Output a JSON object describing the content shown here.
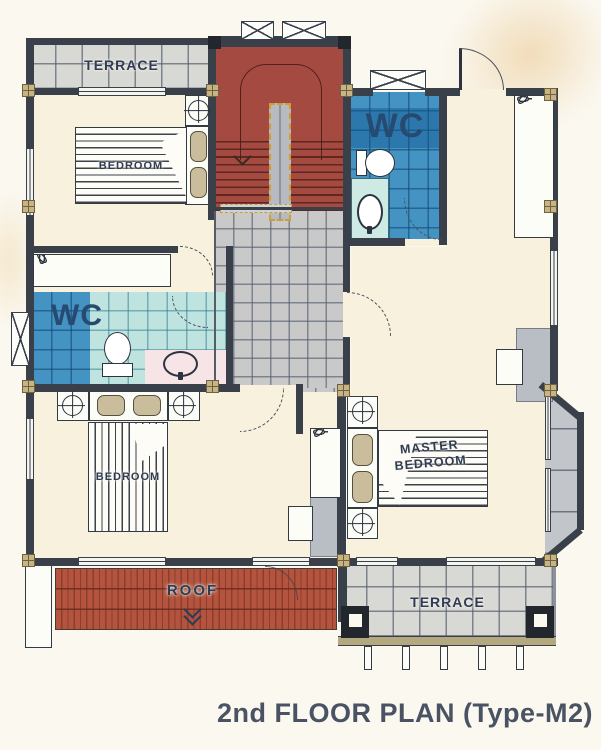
{
  "title": {
    "text": "2nd FLOOR PLAN (Type-M2)"
  },
  "rooms": {
    "terrace_top": {
      "label": "TERRACE"
    },
    "bedroom_top": {
      "label": "BEDROOM"
    },
    "wc_top": {
      "label": "WC"
    },
    "wc_mid": {
      "label": "WC"
    },
    "bedroom_bottom": {
      "label": "BEDROOM"
    },
    "master_bedroom": {
      "line1": "MASTER",
      "line2": "BEDROOM"
    },
    "roof": {
      "label": "ROOF"
    },
    "terrace_bottom": {
      "label": "TERRACE"
    }
  },
  "icons": {
    "stairs_direction": "down-arrow",
    "roof_direction": "double-down-chevron",
    "nightstand_lamp": "crosshair-circle",
    "window_marker": "x-box",
    "wardrobe_contents": "clothes-hangers"
  },
  "colors": {
    "wall": "#39404a",
    "floor_cream": "#f8f1dd",
    "tile_gray": "#c9c9c9",
    "terrace_tile": "#d8d8d5",
    "stairs_red": "#a44a41",
    "roof_red": "#b4543e",
    "wc_blue": "#4493c3",
    "wc_blue_dark": "#2e7ab1",
    "wc_teal": "#bfe3de",
    "wc_pink": "#f7e4e7",
    "bay_gray": "#c2c6cb",
    "post_tan": "#c8b483",
    "railing_gold": "#cf9d32",
    "label_navy": "#2e3b55",
    "wc_text": "#274a70",
    "title_color": "#4a5364"
  }
}
